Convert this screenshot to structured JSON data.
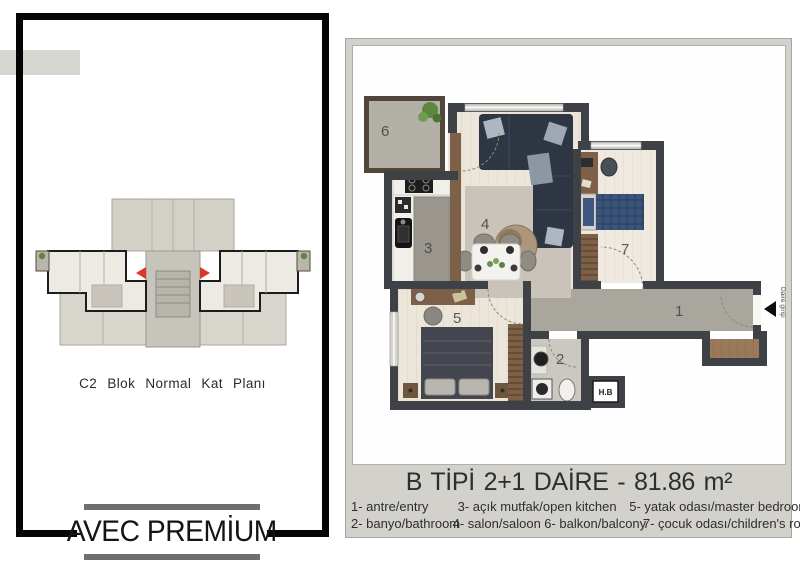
{
  "left_panel": {
    "caption": "C2 Blok Normal Kat Planı",
    "logo": "AVEC PREMİUM"
  },
  "right_panel": {
    "title": "B TİPİ 2+1 DAİRE - 81.86 m²",
    "legend_row1": [
      "1- antre/entry",
      "3- açık mutfak/open kitchen",
      "5- yatak odası/master bedroom"
    ],
    "legend_row2": [
      "2- banyo/bathroom",
      "4- salon/saloon",
      "6- balkon/balcony",
      "7- çocuk odası/children's room"
    ]
  },
  "plan": {
    "rooms": {
      "entry": "1",
      "bathroom": "2",
      "kitchen": "3",
      "salon": "4",
      "bedroom": "5",
      "balcony": "6",
      "children": "7"
    },
    "entry_label": "Daire girişi",
    "shaft_label": "H.B"
  },
  "colors": {
    "wall": "#3e4146",
    "wood_floor": "#ece5da",
    "corridor_floor": "#a9a69d",
    "navy_sofa": "#2d3642",
    "plaid_blue": "#3c5379",
    "furniture_brown": "#7d6047",
    "panel_bg": "#d3d1cb",
    "accent_red": "#d8382c",
    "frame_black": "#050505"
  }
}
